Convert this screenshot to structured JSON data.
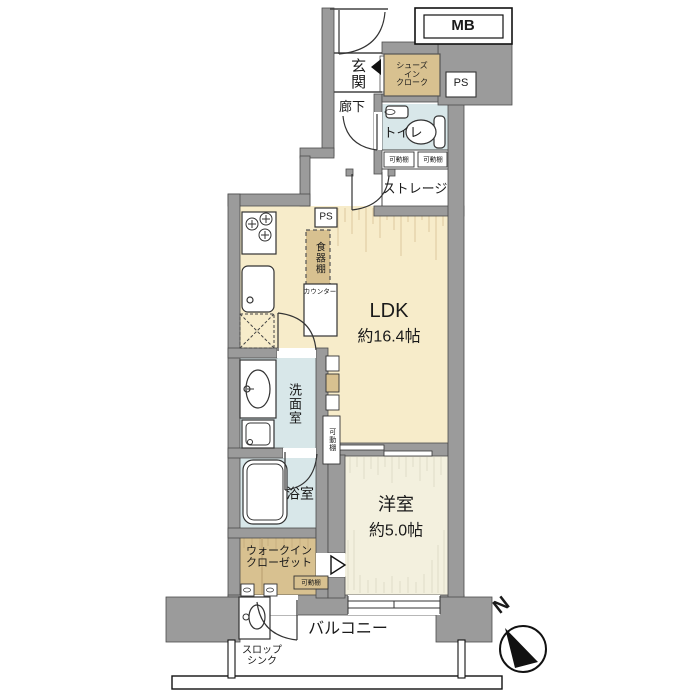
{
  "rooms": {
    "entrance": {
      "label": "玄関"
    },
    "shoe_closet": {
      "line1": "シューズ",
      "line2": "イン",
      "line3": "クローク"
    },
    "corridor": {
      "label": "廊下"
    },
    "toilet": {
      "label": "トイレ"
    },
    "storage": {
      "label": "ストレージ"
    },
    "ldk": {
      "label": "LDK",
      "area": "約16.4帖"
    },
    "washroom": {
      "label": "洗面室"
    },
    "bathroom": {
      "label": "浴室"
    },
    "walk_in_closet": {
      "line1": "ウォークイン",
      "line2": "クローゼット"
    },
    "bedroom": {
      "label": "洋室",
      "area": "約5.0帖"
    },
    "balcony": {
      "label": "バルコニー"
    }
  },
  "labels": {
    "mb": "MB",
    "ps": "PS",
    "movable_shelf": "可動棚",
    "cupboard": "食器棚",
    "counter": "カウンター",
    "slop_sink_line1": "スロップ",
    "slop_sink_line2": "シンク",
    "compass_north": "N"
  },
  "colors": {
    "wall": "#9b9b9b",
    "ldk_floor": "#f7ecca",
    "bedroom_floor": "#f3f0de",
    "wet_area_floor": "#d8e7e9",
    "closet_fill": "#d8c190",
    "outline": "#333333"
  }
}
